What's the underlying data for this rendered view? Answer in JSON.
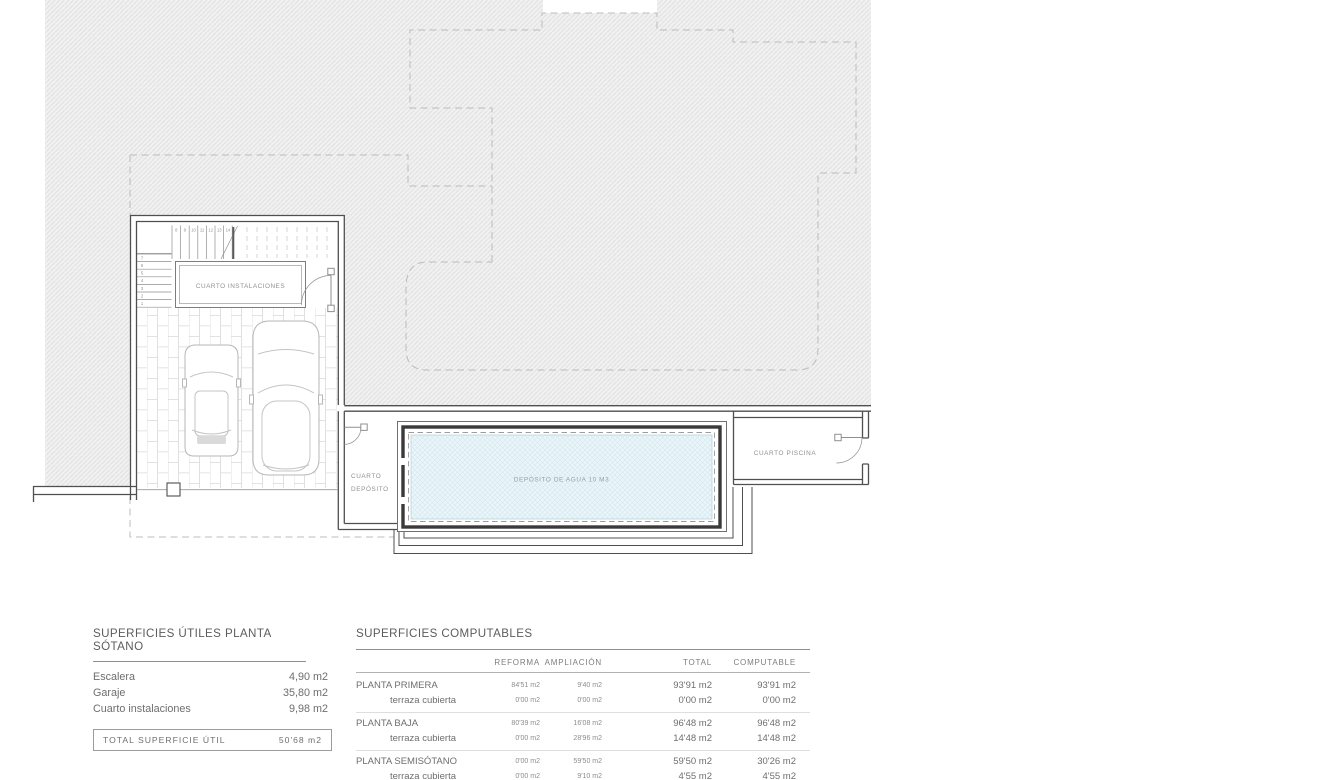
{
  "plan": {
    "labels": {
      "cuarto_instalaciones": "CUARTO INSTALACIONES",
      "cuarto_deposito_l1": "CUARTO",
      "cuarto_deposito_l2": "DEPÓSITO",
      "deposito_agua": "DEPÓSITO DE AGUA 10 M3",
      "cuarto_piscina": "CUARTO PISCINA"
    },
    "stairs": {
      "up": [
        "8",
        "9",
        "10",
        "11",
        "12",
        "13",
        "14"
      ],
      "down": [
        "7",
        "6",
        "5",
        "4",
        "3",
        "2",
        "1"
      ]
    },
    "colors": {
      "hatch_bg": "#f1f1f1",
      "hatch_line": "#dedede",
      "wall": "#4f4f4f",
      "water_fill": "#eaf5f9",
      "water_line": "#d3e8ef",
      "label_text": "#919191"
    }
  },
  "tables": {
    "utiles": {
      "title": "SUPERFICIES ÚTILES PLANTA SÓTANO",
      "rows": [
        {
          "label": "Escalera",
          "value": "4,90 m2"
        },
        {
          "label": "Garaje",
          "value": "35,80 m2"
        },
        {
          "label": "Cuarto instalaciones",
          "value": "9,98 m2"
        }
      ],
      "total_label": "TOTAL SUPERFICIE ÚTIL",
      "total_value": "50'68 m2"
    },
    "computables": {
      "title": "SUPERFICIES COMPUTABLES",
      "columns": [
        "REFORMA",
        "AMPLIACIÓN",
        "TOTAL",
        "COMPUTABLE"
      ],
      "rows": [
        {
          "label": "PLANTA PRIMERA",
          "reforma": "84'51 m2",
          "ampliacion": "9'40 m2",
          "total": "93'91 m2",
          "computable": "93'91 m2"
        },
        {
          "label": "terraza cubierta",
          "reforma": "0'00 m2",
          "ampliacion": "0'00 m2",
          "total": "0'00 m2",
          "computable": "0'00 m2"
        },
        {
          "label": "PLANTA BAJA",
          "reforma": "80'39 m2",
          "ampliacion": "16'08 m2",
          "total": "96'48 m2",
          "computable": "96'48 m2"
        },
        {
          "label": "terraza cubierta",
          "reforma": "0'00 m2",
          "ampliacion": "28'96 m2",
          "total": "14'48 m2",
          "computable": "14'48 m2"
        },
        {
          "label": "PLANTA SEMISÓTANO",
          "reforma": "0'00 m2",
          "ampliacion": "59'50 m2",
          "total": "59'50 m2",
          "computable": "30'26 m2"
        },
        {
          "label": "terraza cubierta",
          "reforma": "0'00 m2",
          "ampliacion": "9'10 m2",
          "total": "4'55 m2",
          "computable": "4'55 m2"
        }
      ]
    }
  }
}
